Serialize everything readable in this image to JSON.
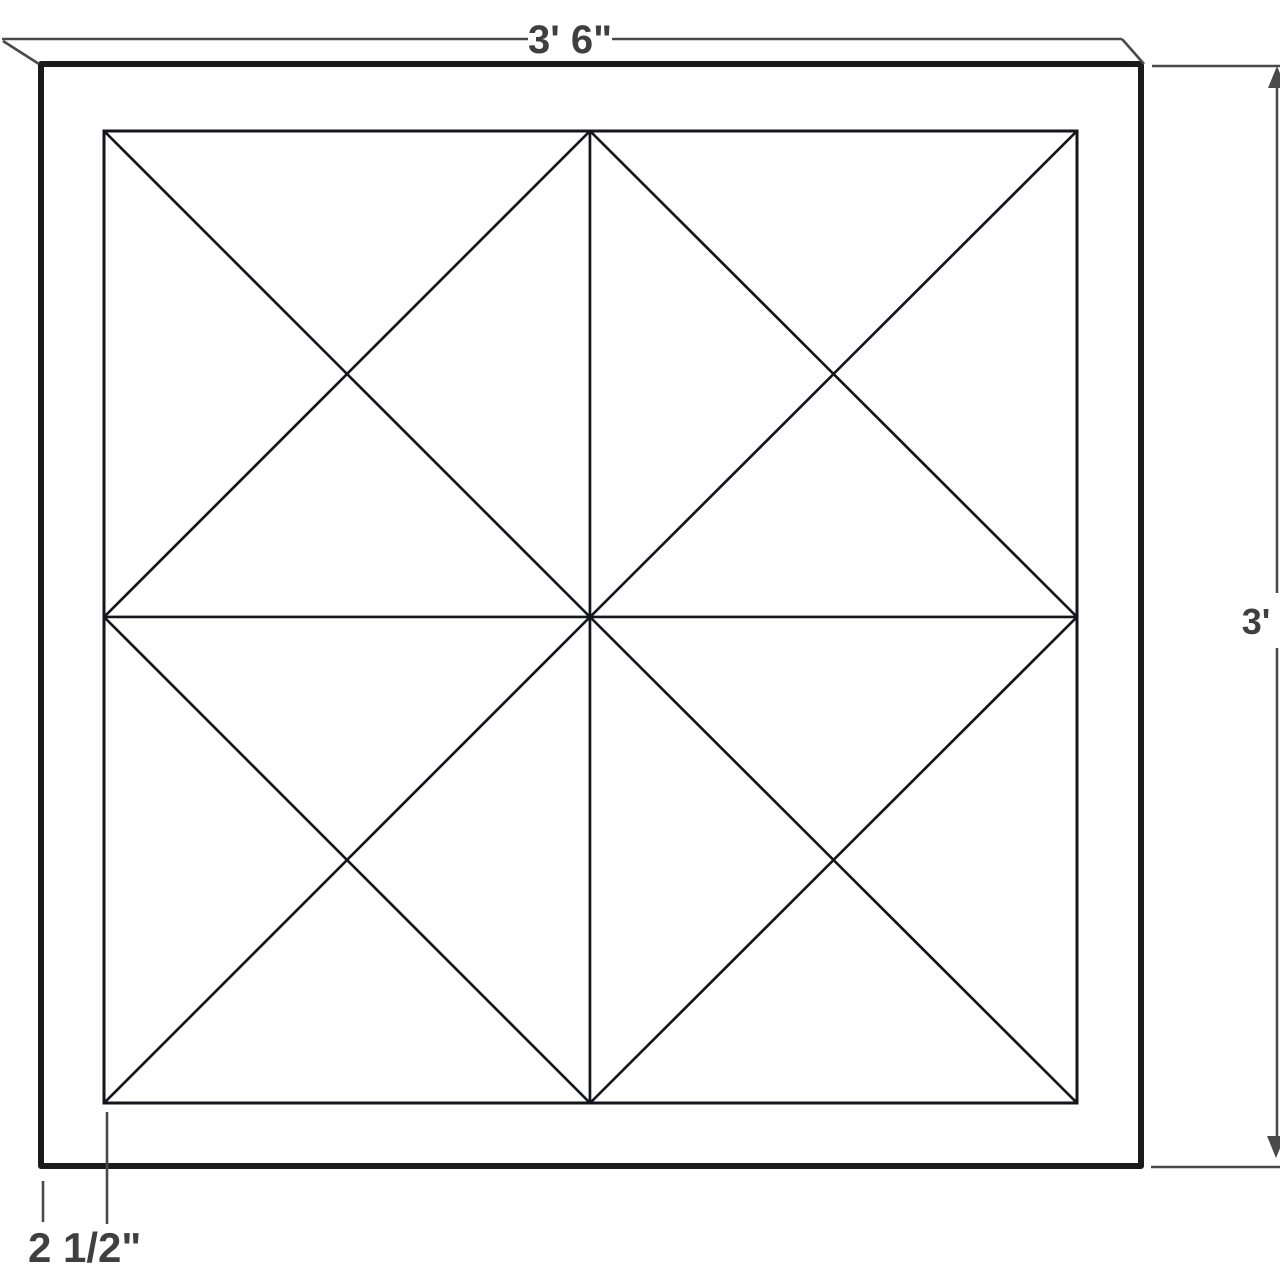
{
  "diagram": {
    "type": "quilt-block-wall-art-plan",
    "colors": {
      "teal": "#009E9A",
      "white": "#FFFFFF",
      "frame": "#1B1B1B",
      "outline": "#15151D",
      "dimension_line": "#4A4A4A",
      "label_text": "#3F3F3F"
    },
    "dimension_labels": {
      "top_width": "3' 6\"",
      "right_height": "3'",
      "bottom_border": "2 1/2\""
    },
    "grid": {
      "rows": 2,
      "cols": 2
    },
    "blocks": [
      {
        "position": "top-left",
        "teal_triangles": [
          "top",
          "bottom"
        ]
      },
      {
        "position": "top-right",
        "teal_triangles": [
          "left",
          "right"
        ]
      },
      {
        "position": "bottom-left",
        "teal_triangles": [
          "left",
          "right"
        ]
      },
      {
        "position": "bottom-right",
        "teal_triangles": [
          "top",
          "bottom"
        ]
      }
    ]
  }
}
